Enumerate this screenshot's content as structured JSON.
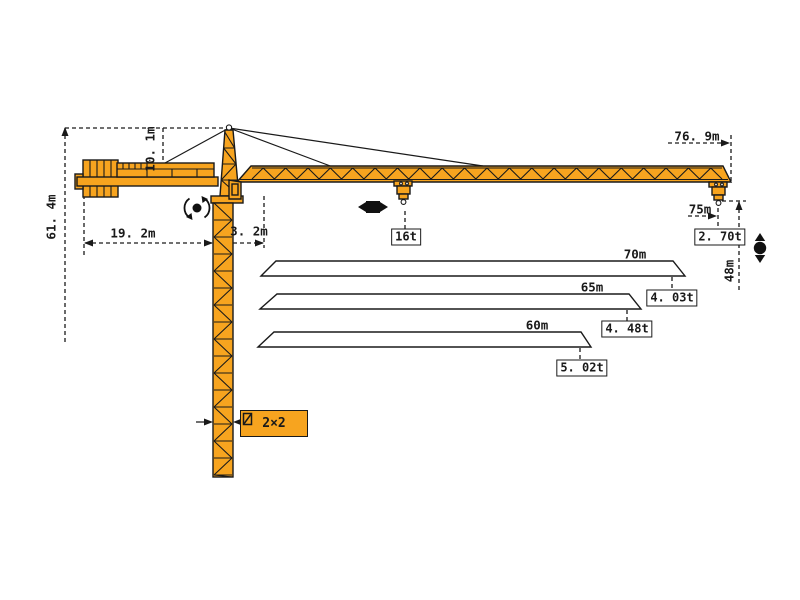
{
  "colors": {
    "crane": "#F7A41F",
    "outline": "#1A1A1A"
  },
  "labels": {
    "total_height": "61. 4m",
    "head_height": "10. 1m",
    "counter_jib_radius": "19. 2m",
    "min_radius": "3. 2m",
    "max_reach": "76. 9m",
    "tip_radius": "75m",
    "hook_height": "48m",
    "tip_load": "2. 70t",
    "max_load": "16t",
    "mast_section": "2×2"
  },
  "load_chart": {
    "type": "table",
    "description": "jib length vs tip load",
    "jibs": [
      {
        "length": "70m",
        "tip_load": "4. 03t"
      },
      {
        "length": "65m",
        "tip_load": "4. 48t"
      },
      {
        "length": "60m",
        "tip_load": "5. 02t"
      }
    ]
  }
}
